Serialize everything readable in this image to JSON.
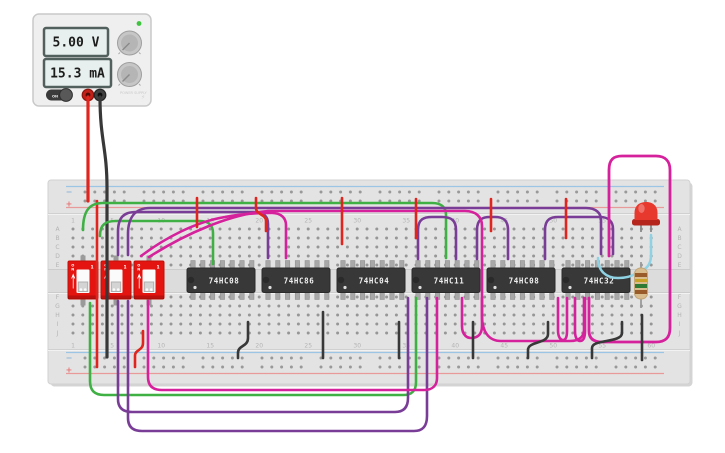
{
  "power_supply": {
    "voltage_display": "5.00 V",
    "current_display": "15.3 mA",
    "brand_label": "POWER SUPPLY",
    "bolt_icon": "⚡",
    "switch_label": "ON",
    "power_led_color": "#3ec43e"
  },
  "breadboard": {
    "rail_minus": "−",
    "rail_plus": "+",
    "row_labels": [
      "A",
      "B",
      "C",
      "D",
      "E",
      "F",
      "G",
      "H",
      "I",
      "J"
    ],
    "column_labels": [
      "1",
      "5",
      "10",
      "15",
      "20",
      "25",
      "30",
      "35",
      "40",
      "45",
      "50",
      "55",
      "60"
    ],
    "ics": [
      {
        "label": "74HC08"
      },
      {
        "label": "74HC86"
      },
      {
        "label": "74HC04"
      },
      {
        "label": "74HC11"
      },
      {
        "label": "74HC08"
      },
      {
        "label": "74HC32"
      }
    ],
    "dip_switches": [
      {
        "on_label": "ON",
        "position_label": "1"
      },
      {
        "on_label": "ON",
        "position_label": "1"
      },
      {
        "on_label": "ON",
        "position_label": "1"
      }
    ]
  },
  "components": {
    "led": {
      "color": "#e8392e",
      "color_name": "red"
    },
    "resistor": {
      "body_color": "#d9bd8e",
      "band_colors": [
        "#9a5b2a",
        "#c9a227",
        "#2f7a34",
        "#9a5b2a"
      ]
    }
  },
  "colors": {
    "board": "#e3e3e3",
    "rail_minus_line": "#9cc4e4",
    "rail_plus_line": "#e89a9a",
    "wire_palette": {
      "red": "#e0251f",
      "black": "#383838",
      "green": "#3fb044",
      "purple": "#7a3d97",
      "magenta": "#d6219c",
      "cyan": "#8ed2e3"
    }
  }
}
